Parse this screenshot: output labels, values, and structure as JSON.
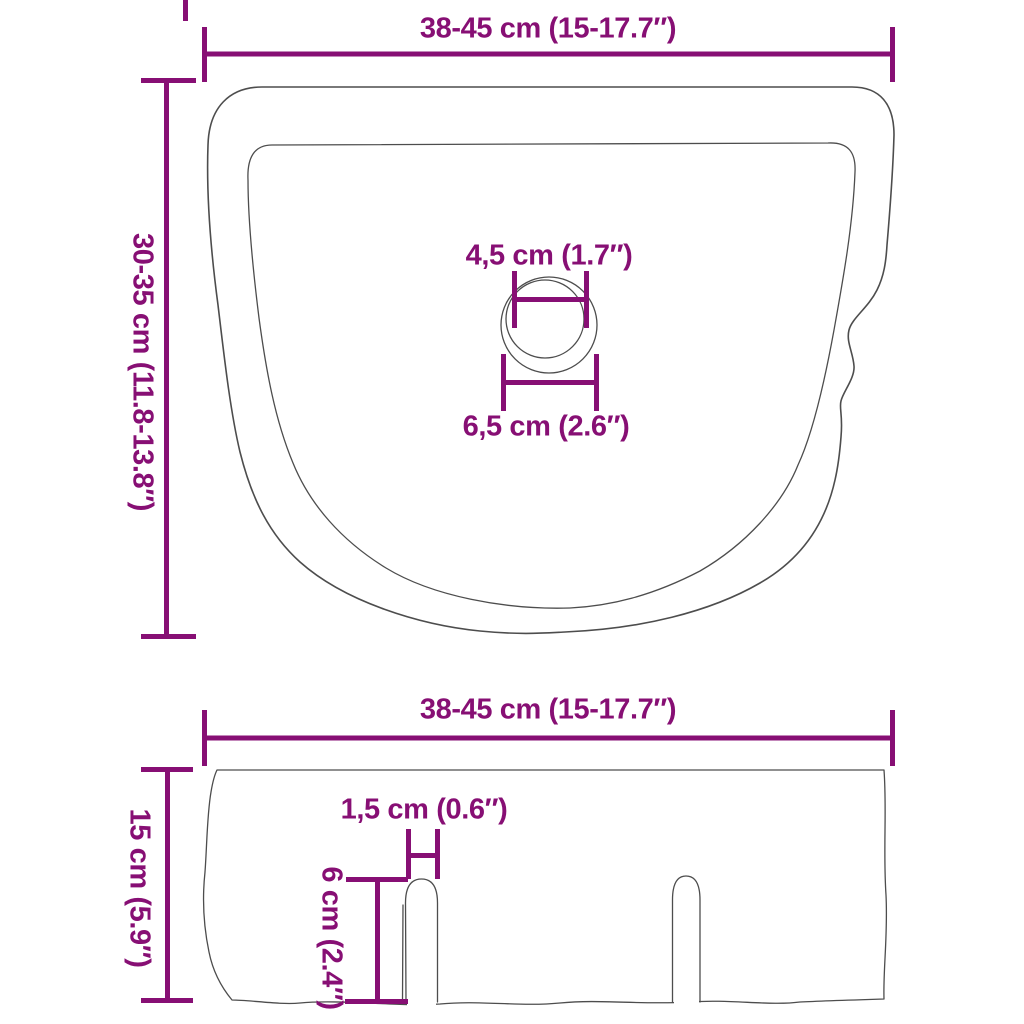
{
  "colors": {
    "dimension_accent": "#870F74",
    "product_outline": "#4D4D4D",
    "background": "#FFFFFF"
  },
  "top_view": {
    "width_label": "38-45 cm (15-17.7″)",
    "depth_label": "30-35 cm (11.8-13.8″)",
    "drain_inner_diameter_label": "4,5 cm (1.7″)",
    "drain_outer_diameter_label": "6,5 cm (2.6″)"
  },
  "side_view": {
    "width_label": "38-45 cm (15-17.7″)",
    "height_label": "15 cm (5.9″)",
    "slot_width_label": "1,5 cm (0.6″)",
    "slot_depth_label": "6 cm (2.4″)"
  }
}
